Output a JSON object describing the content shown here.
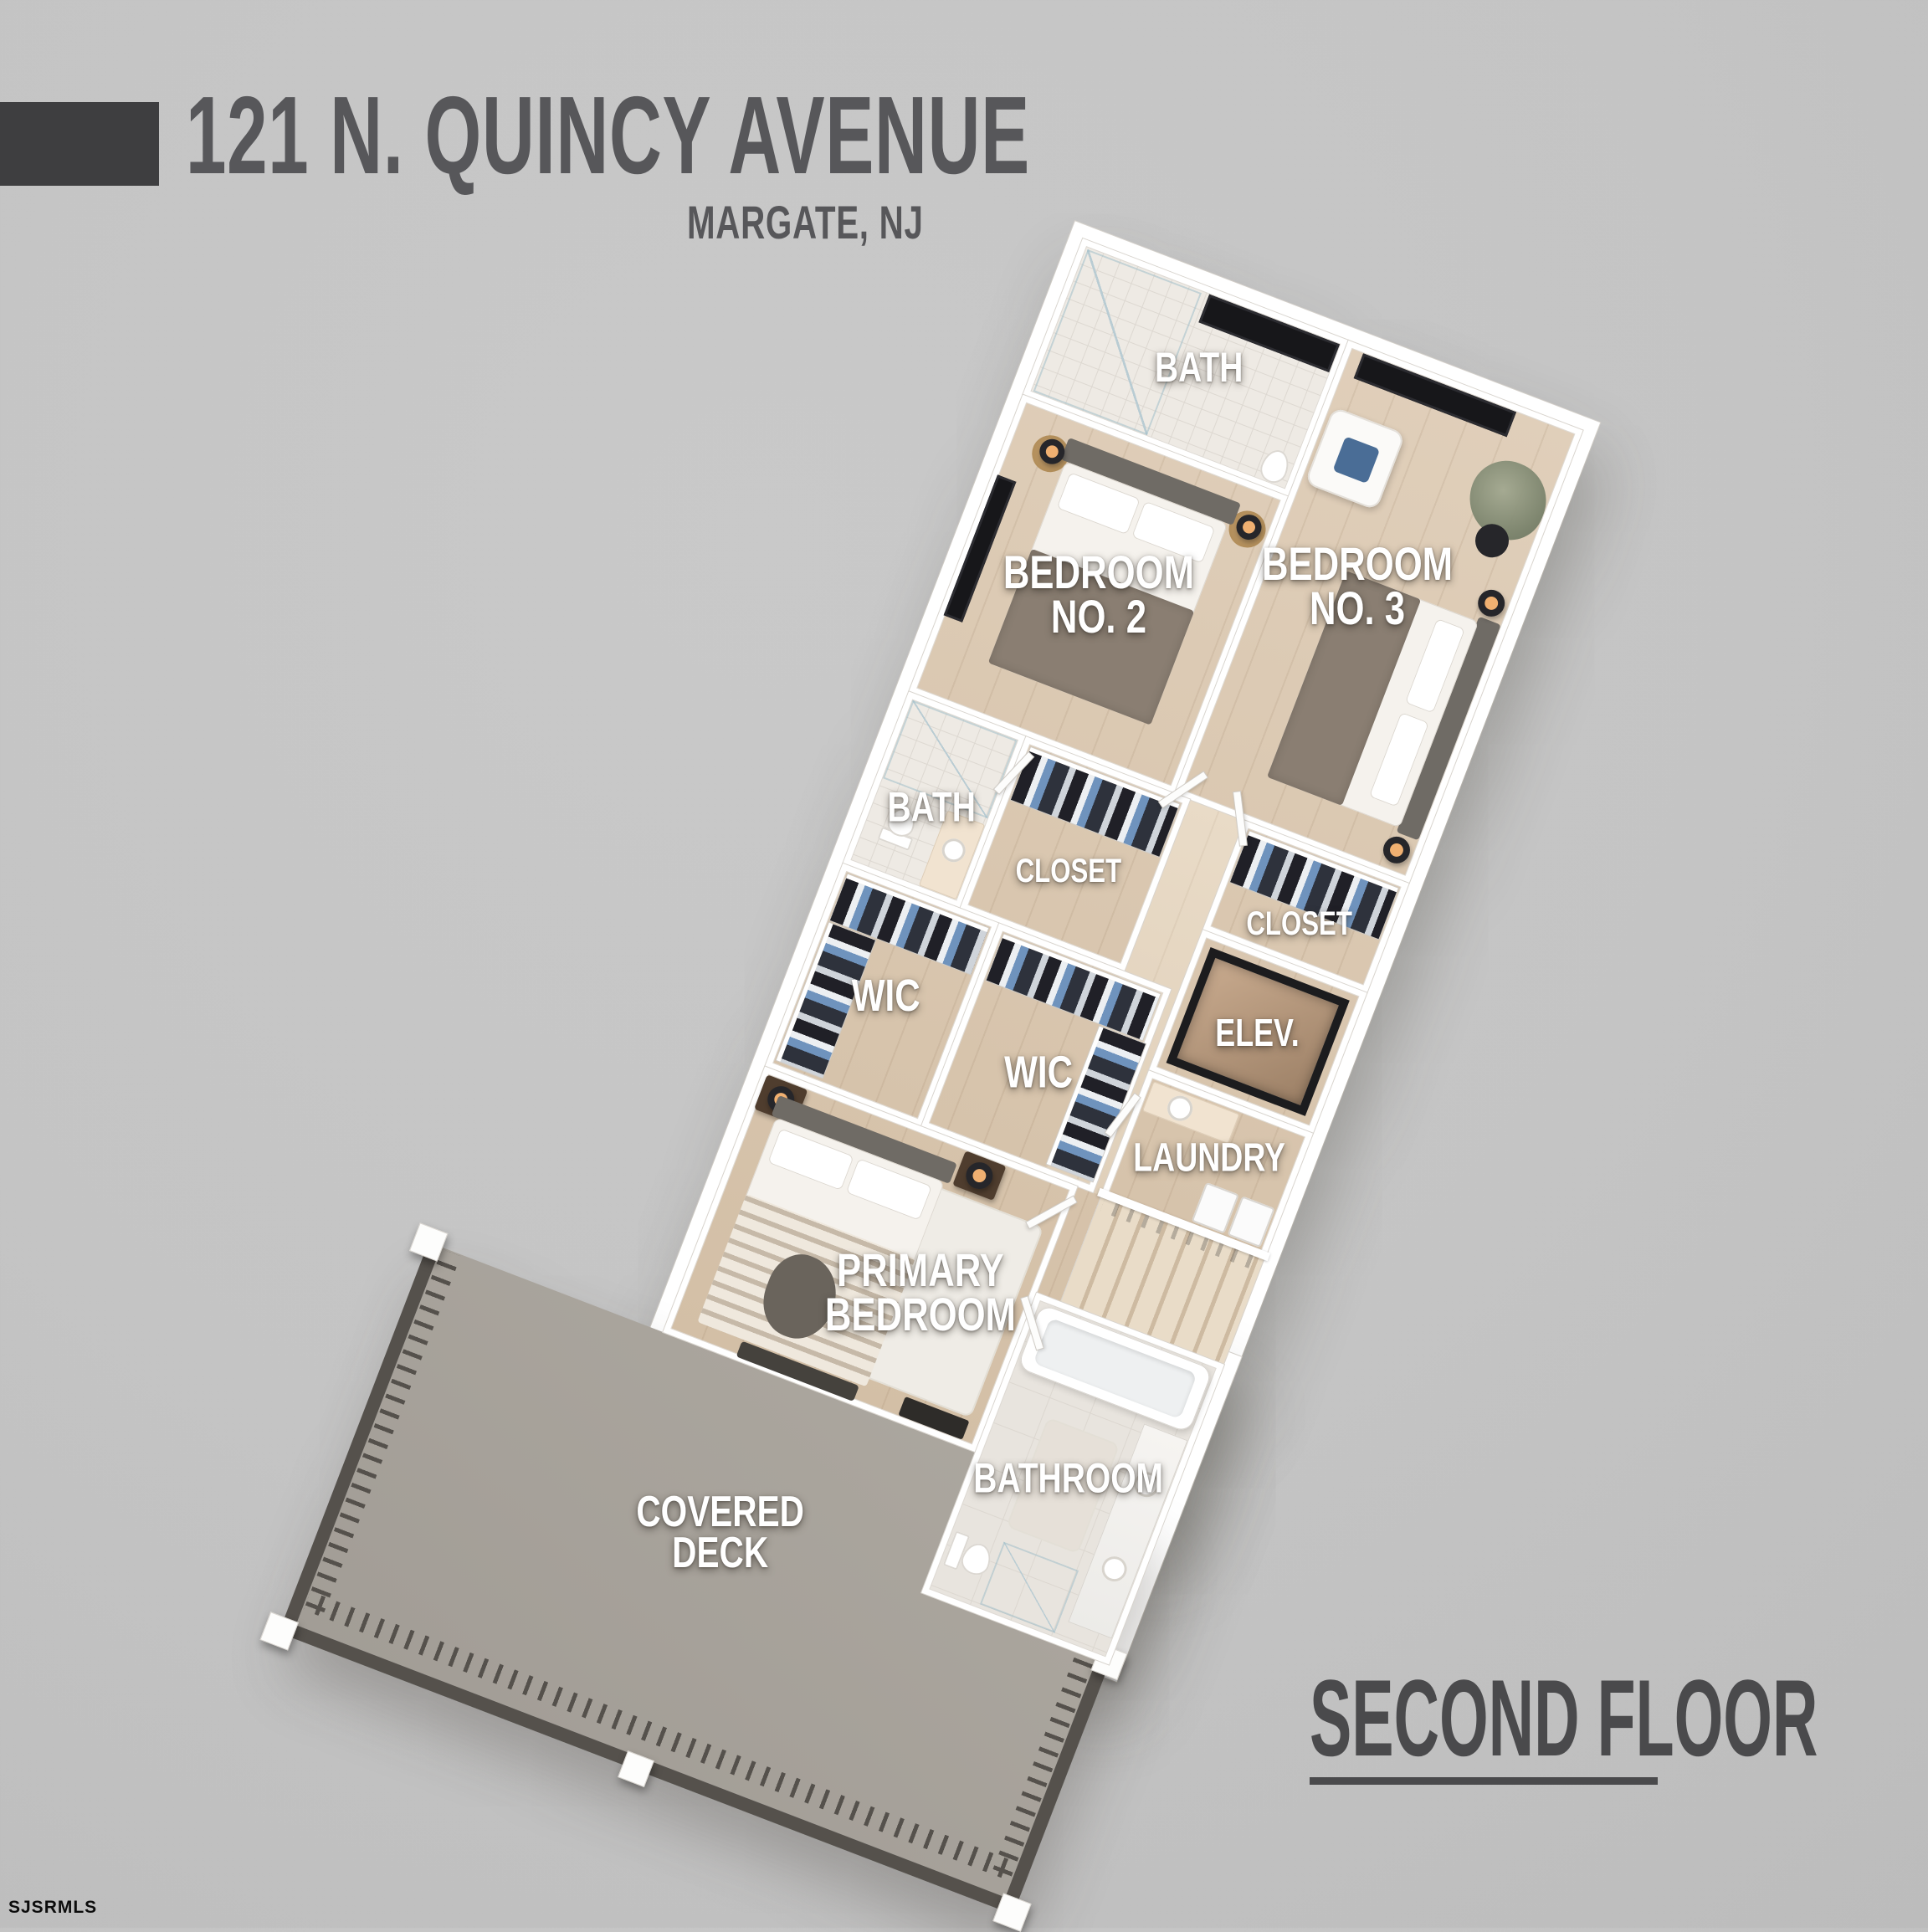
{
  "header": {
    "address": "121 N. QUINCY AVENUE",
    "city": "MARGATE, NJ"
  },
  "footer": {
    "floor_title": "SECOND FLOOR",
    "watermark": "SJSRMLS"
  },
  "rooms": {
    "bath_top": {
      "label": "BATH"
    },
    "bedroom_2": {
      "l1": "BEDROOM",
      "l2": "NO. 2"
    },
    "bedroom_3": {
      "l1": "BEDROOM",
      "l2": "NO. 3"
    },
    "bath_mid": {
      "label": "BATH"
    },
    "closet_2": {
      "label": "CLOSET"
    },
    "closet_3": {
      "label": "CLOSET"
    },
    "elevator": {
      "label": "ELEV."
    },
    "laundry": {
      "label": "LAUNDRY"
    },
    "wic_left": {
      "label": "WIC"
    },
    "wic_right": {
      "label": "WIC"
    },
    "primary_bedroom": {
      "l1": "PRIMARY",
      "l2": "BEDROOM"
    },
    "bathroom": {
      "label": "BATHROOM"
    },
    "covered_deck": {
      "l1": "COVERED",
      "l2": "DECK"
    }
  },
  "colors": {
    "background": "#c4c4c4",
    "title_text": "#57575a",
    "title_block": "#3e3e40",
    "floor_title_text": "#4a4a4c",
    "label_text": "#ffffff",
    "wall": "#ffffff",
    "wood_floor": "#d9c6af",
    "tile_floor": "#eeeae4",
    "deck_floor": "#a8a39c",
    "deck_rail": "#55514c",
    "accent_clothes_blue": "#6f93bd",
    "lamp_glow": "#f0b071"
  }
}
